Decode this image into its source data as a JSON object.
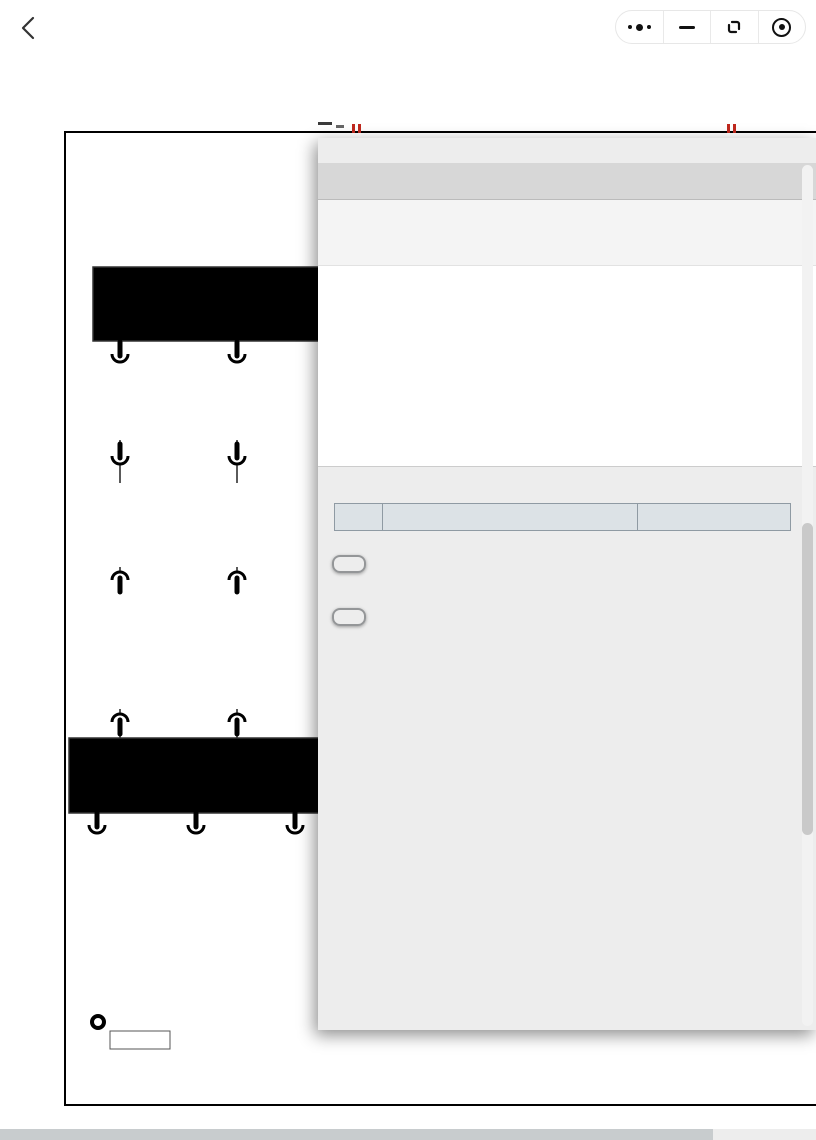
{
  "topbar": {
    "title": "发动机系统电路图"
  },
  "page": {
    "heading": "发动机系统电路图"
  },
  "colors": {
    "wire_blue": "#1d55c4",
    "wire_yellow": "#f2e40c",
    "wire_black": "#121212",
    "wire_tan": "#b89a55",
    "label_blue": "#1d55c4",
    "box_blue": "#b7d9ee",
    "modal_header_blue": "#2273c6",
    "modal_header_blue_light": "#4a99e4",
    "button_blue": "#2a7cd0",
    "button_blue_light": "#5aa2e6"
  },
  "diagram": {
    "module_box": {
      "title": "燃油蒸发泄漏诊断模块",
      "pin_left": "气泵负极",
      "pin_right": "加热组件负极"
    },
    "col1": {
      "conn1": "KA99 -1",
      "wire": "L/W 0.35",
      "conn2": [
        "KJB01",
        "BJK01",
        "-5"
      ],
      "conn3": [
        "BJA02",
        "AJB02",
        "-16"
      ],
      "conn4": "A01(A) -96"
    },
    "col2": {
      "conn1": "KA99 -2",
      "wire": "Y 0.35",
      "conn2": [
        "KJB01",
        "BJK01",
        "-6"
      ],
      "conn3": [
        "BJA02",
        "AJB02",
        "-17"
      ],
      "conn4": "A01(A) -74"
    },
    "ground_box": {
      "pin_left": "气泵负极",
      "pin_right": "加热组件负极",
      "ground_label": "接地"
    },
    "grounds": [
      {
        "pin": "A01(A) -26",
        "wire": "B 0.75"
      },
      {
        "pin": "A01(A) -44",
        "wire": "B 0.5"
      },
      {
        "pin": "A",
        "wire": "B 0.5"
      }
    ],
    "splice": "SP3733"
  },
  "modal": {
    "title": "信息",
    "close_label": "X",
    "component_code": "A01(B)",
    "component_desc": "ECU",
    "connector": {
      "large_pins": [
        [
          1,
          2
        ],
        [
          3,
          4
        ],
        [
          5,
          6
        ]
      ],
      "small_rows": [
        [
          7,
          23
        ],
        [
          24,
          40
        ],
        [
          41,
          57
        ],
        [
          58,
          74
        ],
        [
          75,
          91
        ]
      ]
    },
    "table": {
      "headers": [
        "引脚",
        "功能说明",
        "配置"
      ],
      "rows": [
        [
          "1",
          "接地",
          "ALL"
        ],
        [
          "2",
          "接地",
          "ALL"
        ],
        [
          "3",
          "接地",
          "ALL"
        ],
        [
          "4",
          "非持续电1",
          "ALL"
        ],
        [
          "5",
          "非持续电4",
          "ALL"
        ],
        [
          "6",
          "非持续电3",
          "ALL"
        ],
        [
          "7",
          "-",
          "-"
        ],
        [
          "8",
          "-",
          "-"
        ],
        [
          "9",
          "EVVT（进气）旋向",
          "ALL"
        ],
        [
          "10",
          "-",
          "-"
        ],
        [
          "11",
          "-",
          "-"
        ],
        [
          "12",
          "进气总管压力传感器信号",
          "ALL"
        ],
        [
          "13",
          "后氧传感器信号",
          "ALL"
        ]
      ]
    },
    "harness_button": "线束布置图",
    "harness_link": "发动机线束布置图",
    "ground_button": "接地点布置"
  }
}
